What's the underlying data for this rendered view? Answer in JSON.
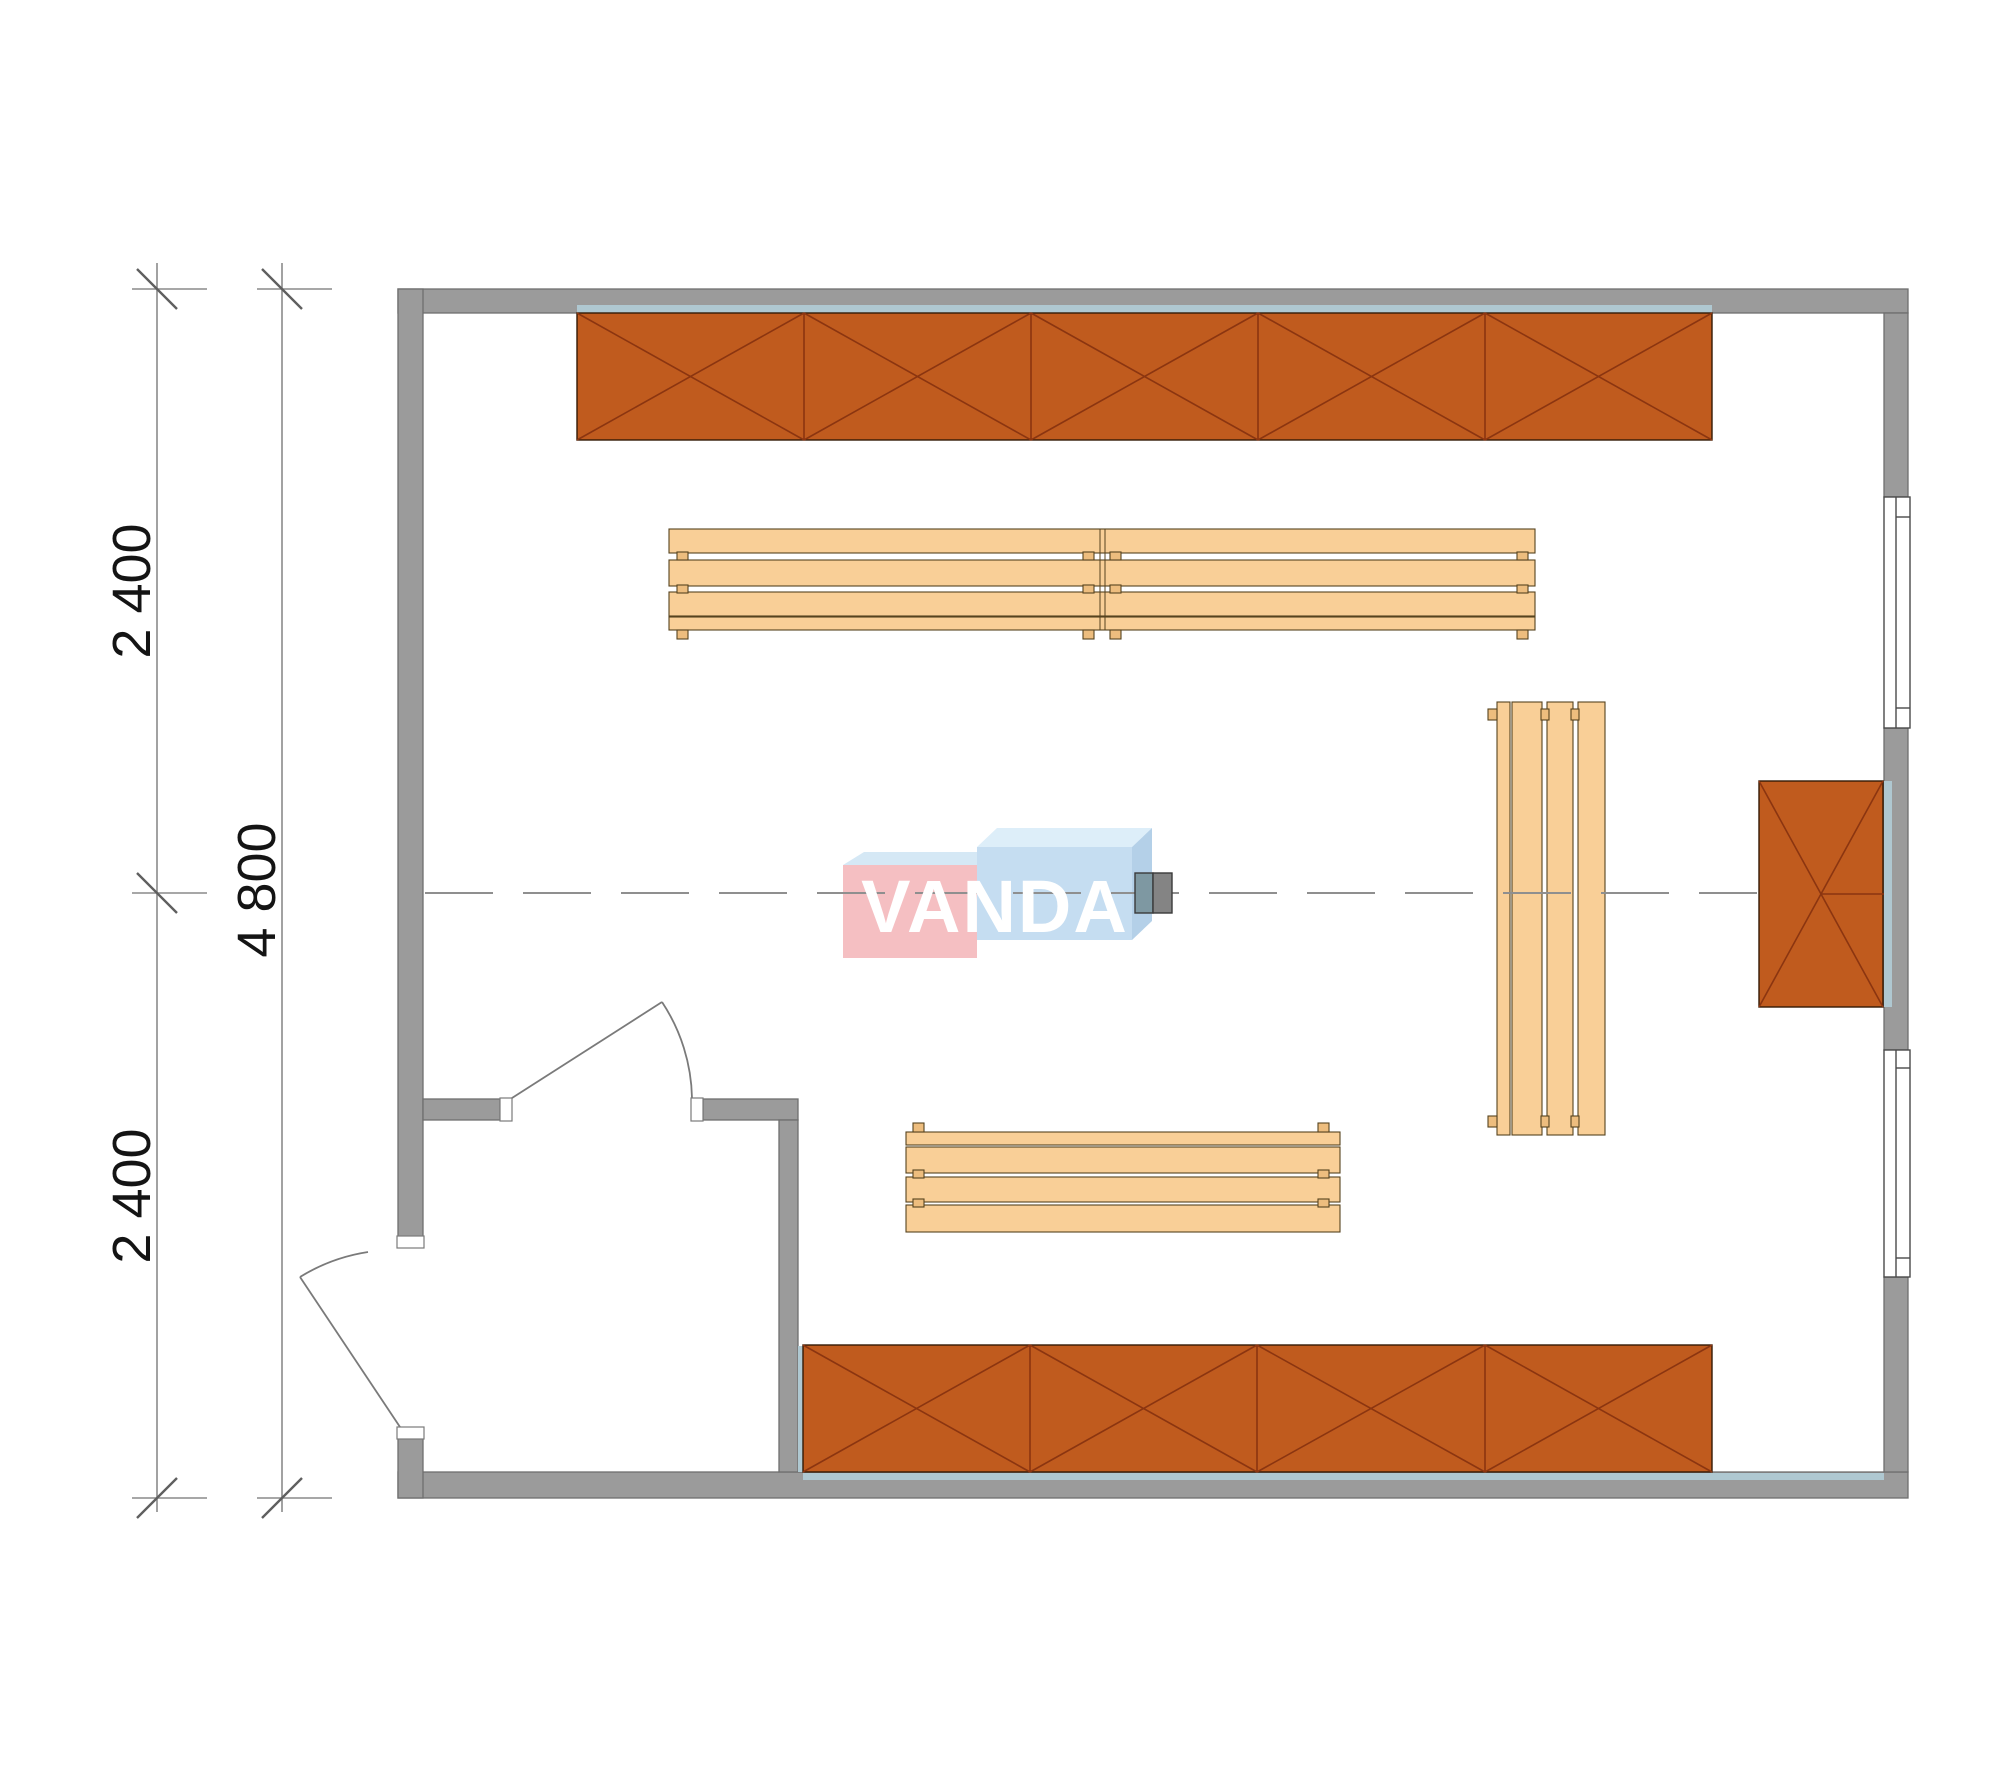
{
  "document": {
    "type": "architectural floor plan",
    "description": "Top-view CAD plan of a rectangular sauna/cabin room with wall cabinets, slatted benches, two doors, two windows and a centerline"
  },
  "watermark": {
    "text": "VANDA"
  },
  "dimensions": {
    "vertical_top_segment": "2 400",
    "vertical_bottom_segment": "2 400",
    "vertical_total": "4 800"
  },
  "furniture": {
    "top_cabinet_sections": 5,
    "bottom_cabinet_sections": 4,
    "right_cabinet_sections": 1,
    "bench_count": 3,
    "door_count": 2,
    "window_count": 2,
    "equipment_count": 1
  },
  "colors": {
    "wall_fill": "#9B9B9B",
    "wall_stroke": "#6F6F6F",
    "cabinet_fill": "#C05B1E",
    "cabinet_stroke": "#331A05",
    "cabinet_cross": "#8B3510",
    "bench_fill": "#F9CF97",
    "bench_stroke": "#56431F",
    "bench_peg_fill": "#EDBD7E",
    "glass_strip": "#AFC8D1",
    "dim_line": "#8A8A8A",
    "dim_tick": "#5F5F5F",
    "dim_text": "#141414",
    "centerline": "#8F8F8F",
    "door_line": "#7A7A7A",
    "window_line": "#4A4A4A",
    "jamb_fill": "#FFFFFF",
    "logo_pink": "#F5BFC2",
    "logo_pink_top": "#D5E8F5",
    "logo_blue": "#C5DDF1",
    "logo_blue_top": "#DDEEF9",
    "logo_blue_side": "#B4D0E8",
    "logo_text_color": "#FFFFFF",
    "equipment_left": "#7E98A2",
    "equipment_right": "#848484",
    "equipment_stroke": "#3A3A3A"
  }
}
